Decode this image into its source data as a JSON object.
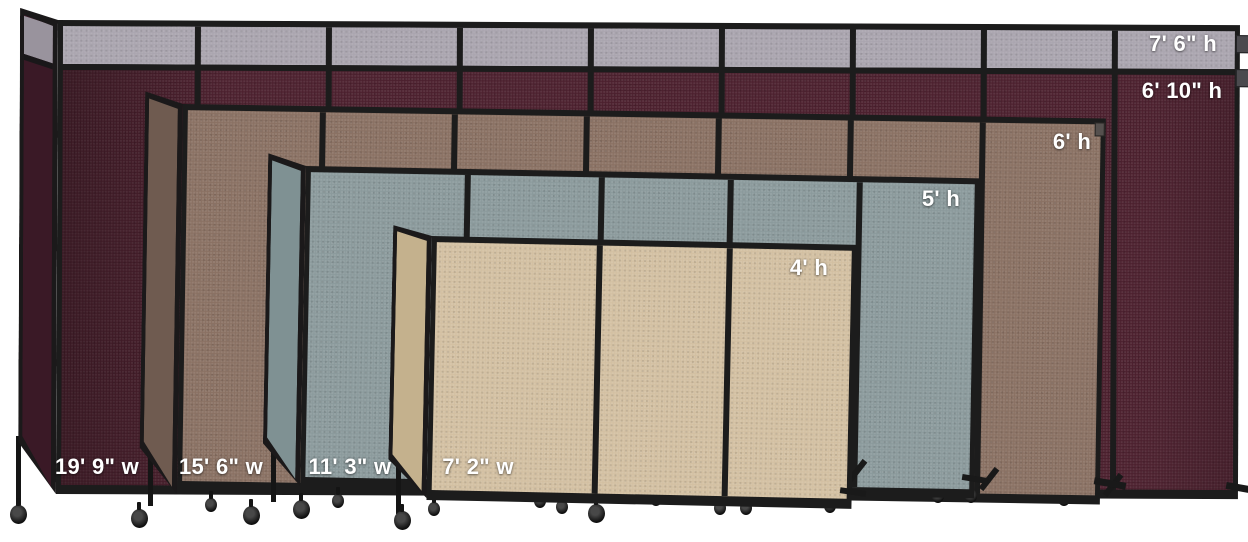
{
  "comparison": {
    "description_labels": {
      "heights": [
        "7' 6\" h",
        "6' 10\" h",
        "6' h",
        "5' h",
        "4' h"
      ],
      "widths": [
        "19' 9\" w",
        "15' 6\" w",
        "11' 3\" w",
        "7' 2\" w"
      ]
    },
    "dividers": [
      {
        "name": "burgundy-room-divider",
        "fabric_color": "#4c202e",
        "height_label": "6' 10\" h",
        "width_label": "19' 9\" w",
        "top_extension": {
          "fabric_color": "#aaa5af",
          "height_label": "7' 6\" h"
        }
      },
      {
        "name": "brown-room-divider",
        "fabric_color": "#8a7163",
        "height_label": "6' h",
        "width_label": "15' 6\" w"
      },
      {
        "name": "slate-room-divider",
        "fabric_color": "#8b9a9c",
        "height_label": "5' h",
        "width_label": "11' 3\" w"
      },
      {
        "name": "beige-room-divider",
        "fabric_color": "#d3c0a2",
        "height_label": "4' h",
        "width_label": "7' 2\" w"
      }
    ],
    "frame_color": "#1c1c1c",
    "label_text_color": "#ffffff",
    "background_color": "#ffffff"
  }
}
